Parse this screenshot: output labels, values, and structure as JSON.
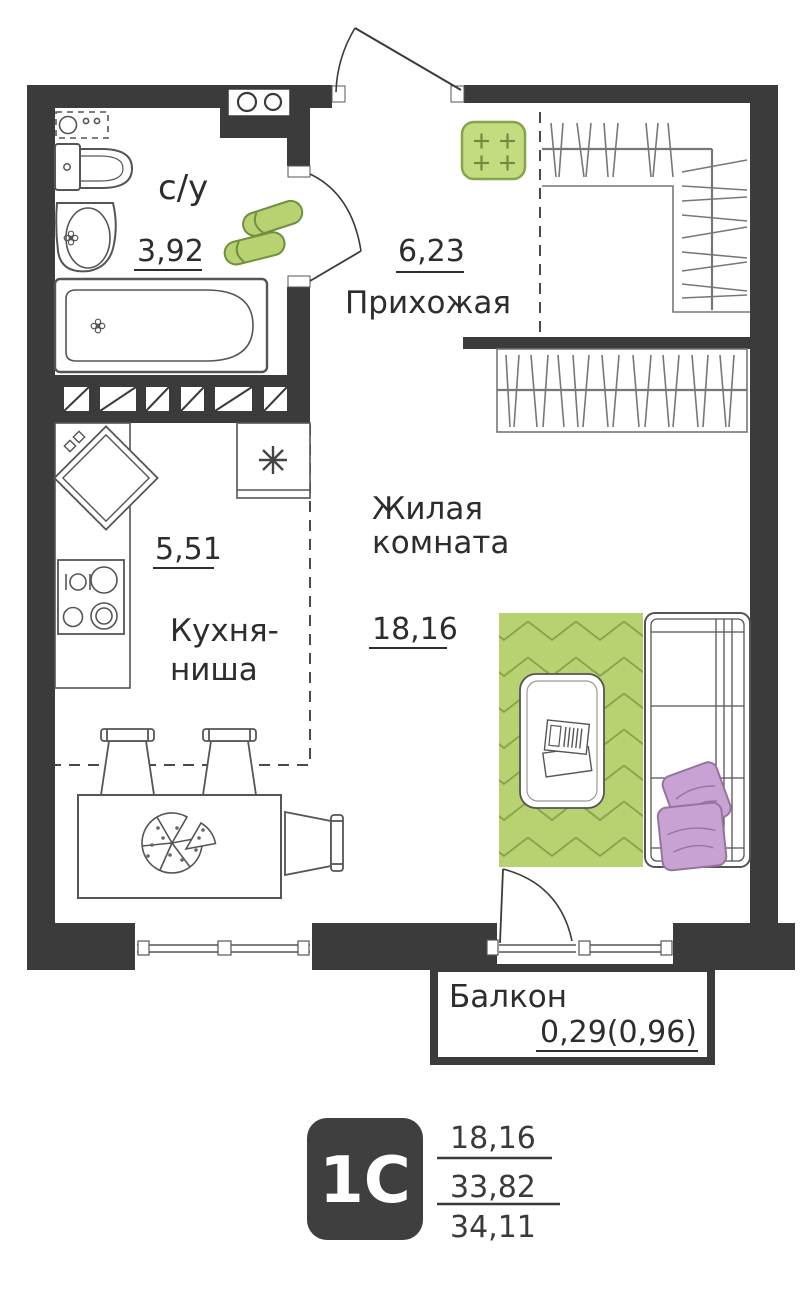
{
  "plan_title": "1-room studio floor plan",
  "rooms": {
    "bathroom": {
      "name": "с/у",
      "area": "3,92"
    },
    "hallway": {
      "name": "Прихожая",
      "area": "6,23"
    },
    "kitchen": {
      "name_line1": "Кухня-",
      "name_line2": "ниша",
      "area": "5,51"
    },
    "living": {
      "name_line1": "Жилая",
      "name_line2": "комната",
      "area": "18,16"
    },
    "balcony": {
      "name": "Балкон",
      "area": "0,29(0,96)"
    }
  },
  "legend": {
    "type_code": "1С",
    "living_area": "18,16",
    "area_without_balcony": "33,82",
    "total_area": "34,11"
  },
  "colors": {
    "wall": "#3b3b3b",
    "furniture_line": "#555555",
    "accent_green": "#b8d271",
    "accent_green_dark": "#86a24c",
    "mat_green": "#c3dc80",
    "pillow_purple": "#c9a2d4",
    "pillow_outline": "#97739f",
    "text": "#2d2d2d"
  }
}
